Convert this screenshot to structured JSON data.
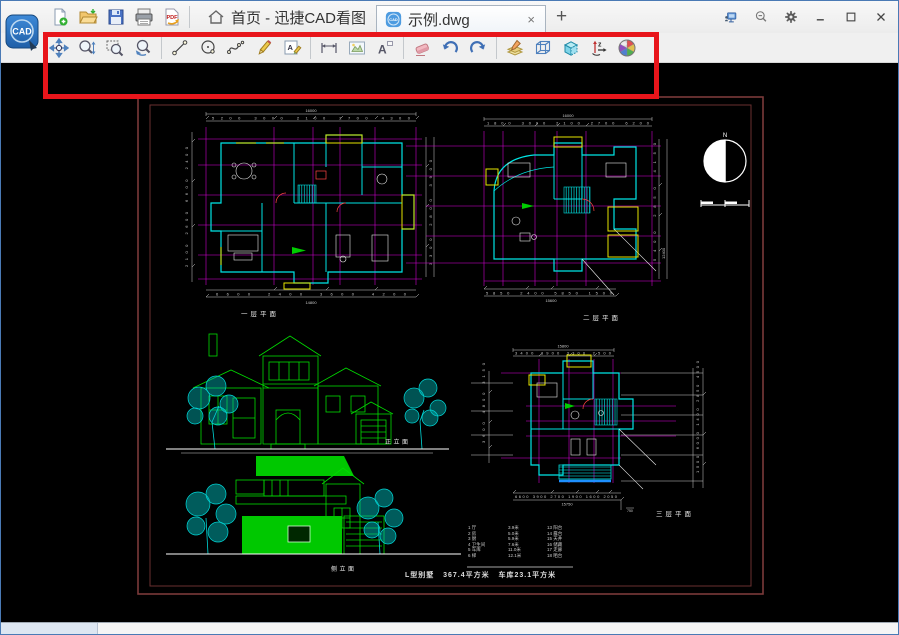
{
  "titlebar": {
    "logo_text": "CAD",
    "home_tab_label": "首页 - 迅捷CAD看图",
    "doc_tab_label": "示例.dwg",
    "close_tab_glyph": "×",
    "new_tab_glyph": "+",
    "quick_icons": [
      "new-file",
      "open-file",
      "save",
      "print",
      "export-pdf"
    ],
    "right_icons": [
      "remote-monitor",
      "zoom-search",
      "settings",
      "minimize",
      "maximize",
      "close"
    ]
  },
  "toolbar": {
    "icons": [
      "pan",
      "zoom-dynamic",
      "zoom-window",
      "zoom-previous",
      "line",
      "circle",
      "spline",
      "brush",
      "text-edit",
      "measure-length",
      "measure-area",
      "text-annotation",
      "eraser",
      "undo",
      "redo",
      "layers",
      "view-3d-wireframe",
      "view-3d-solid",
      "rotate-axis",
      "color-wheel"
    ],
    "highlight_color": "#e8151b"
  },
  "canvas": {
    "background": "#000000",
    "frame_color": "#7a3a3a",
    "labels": {
      "plan1": "一层平面",
      "plan2": "二层平面",
      "front_elevation": "正立面",
      "side_elevation": "侧立面",
      "plan3": "三层平面",
      "north": "N"
    },
    "plan1": {
      "dims_top": "5200   3000  2100  2700    4300",
      "total_top": "16000",
      "dims_bottom": "6600     2400    3600    4200",
      "total_bottom": "14800",
      "dims_left": "2100  2600  6600  2400",
      "dims_right": "3300  2800  3900"
    },
    "plan2": {
      "dims_top": "1800  3000 2100 2700   6200",
      "total_top": "16000",
      "dims_right": "5400  2850  4150",
      "total_right": "12400",
      "dims_bottom": "5850   2400   5850  1500",
      "total_bottom": "15600"
    },
    "plan3": {
      "dims_top": "3400  3900  3300 2500",
      "total_top": "15800",
      "dims_left": "3600  4800  3150",
      "dims_right": "1500 6000 1400 2850 4500",
      "dims_bottom": "6600  3900 2700 1900 1600 2050",
      "total_bottom": "15750",
      "offset_note": "750"
    },
    "legend": {
      "col1": "1 厅\n2 房\n3 厨\n4 卫生间\n5 车库\n6 梯",
      "col2": "3.9米\n5.0米\n5.9米\n7.6米\n11.0米\n12.1米",
      "col3": "13 阳台\n14 露台\n15 天井\n16 储藏\n17 走廊\n18 晒台"
    },
    "caption": "L型别墅   367.4平方米   车库23.1平方米"
  }
}
